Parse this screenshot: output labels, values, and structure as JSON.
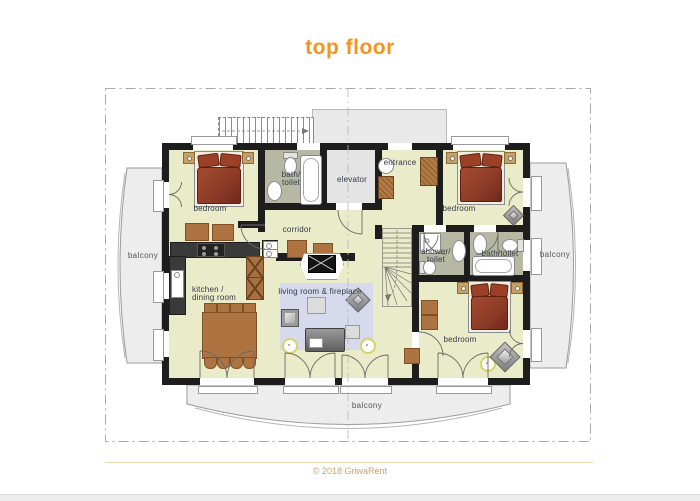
{
  "title": "top floor",
  "plan": {
    "rooms": {
      "bedroom_top_left": {
        "label": "bedroom"
      },
      "bedroom_top_right": {
        "label": "bedroom"
      },
      "bedroom_bottom_right": {
        "label": "bedroom"
      },
      "bath_toilet_top": {
        "label_line1": "bath/",
        "label_line2": "toilet"
      },
      "elevator": {
        "label": "elevator"
      },
      "entrance": {
        "label": "entrance"
      },
      "corridor": {
        "label": "corridor"
      },
      "shower_toilet": {
        "label_line1": "shower/",
        "label_line2": "toilet"
      },
      "bath_toilet_right": {
        "label": "bath/toilet"
      },
      "kitchen_dining": {
        "label_line1": "kitchen /",
        "label_line2": "dining room"
      },
      "living_room": {
        "label": "living room & fireplace"
      },
      "balcony_left": {
        "label": "balcony"
      },
      "balcony_right": {
        "label": "balcony"
      },
      "balcony_bottom": {
        "label": "balcony"
      }
    }
  },
  "footer": {
    "copyright": "© 2018 GriwaRent"
  },
  "colors": {
    "accent_orange": "#f6921e",
    "room_fill": "#eaebc8",
    "bathroom_fill": "#b6b8a3",
    "elevator_fill": "#e4e4e4",
    "wall": "#1d1d1d",
    "rug": "#d7d9ec",
    "bed": "#8e3c28",
    "wood": "#ad7442",
    "balcony_fill": "#ededed",
    "copyright_text": "#cfa068"
  }
}
